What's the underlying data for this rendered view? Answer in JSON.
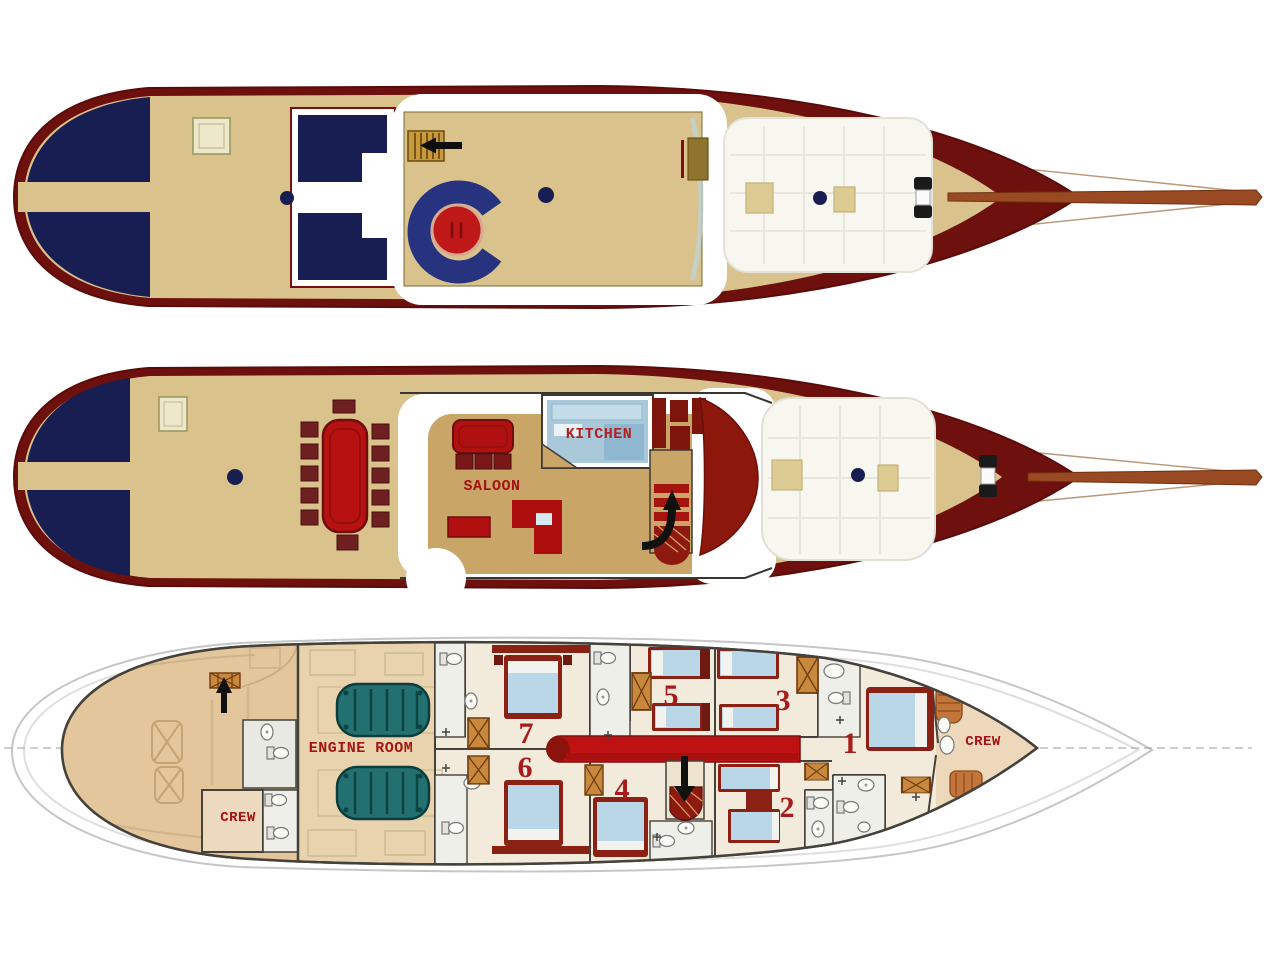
{
  "diagram": {
    "kind": "yacht-deck-plans",
    "description": "Three stacked deck plans of a two-masted motor-sailer yacht: sun deck, main deck with saloon and kitchen, and lower deck with seven numbered guest cabins, engine room and crew quarters"
  },
  "labels": {
    "saloon": "SALOON",
    "kitchen": "KITCHEN",
    "engine_room": "ENGINE ROOM",
    "crew_aft": "CREW",
    "crew_fore": "CREW",
    "cabin_numbers": [
      "1",
      "2",
      "3",
      "4",
      "5",
      "6",
      "7"
    ]
  },
  "icons": {
    "sun_deck_companionway_arrow": "left-arrow",
    "main_deck_stairs_arrow": "up-arrow",
    "lower_deck_aft_stairs_arrow": "up-arrow",
    "lower_deck_main_stairs_arrow": "down-arrow",
    "masts": "navy-dot",
    "wardrobes": "crosshatched-box",
    "toilets": "bowl-and-tank",
    "sinks": "oval-basin"
  },
  "colors": {
    "hull_maroon": "#6E100E",
    "deck_tan": "#D9C28C",
    "sunpad_navy": "#191E52",
    "table_red": "#B81111",
    "corridor_red": "#BE1212",
    "engine_teal": "#237070",
    "mattress_blue": "#BAD7E7",
    "kitchen_blue": "#A9C9DB",
    "saloon_floor": "#C9A568",
    "lower_floor": "#E9D3AE",
    "label_red": "#A31414",
    "bed_frame_red": "#8B2015",
    "wardrobe_wood": "#C8893C",
    "bowsprit_brown": "#9A4A22"
  }
}
